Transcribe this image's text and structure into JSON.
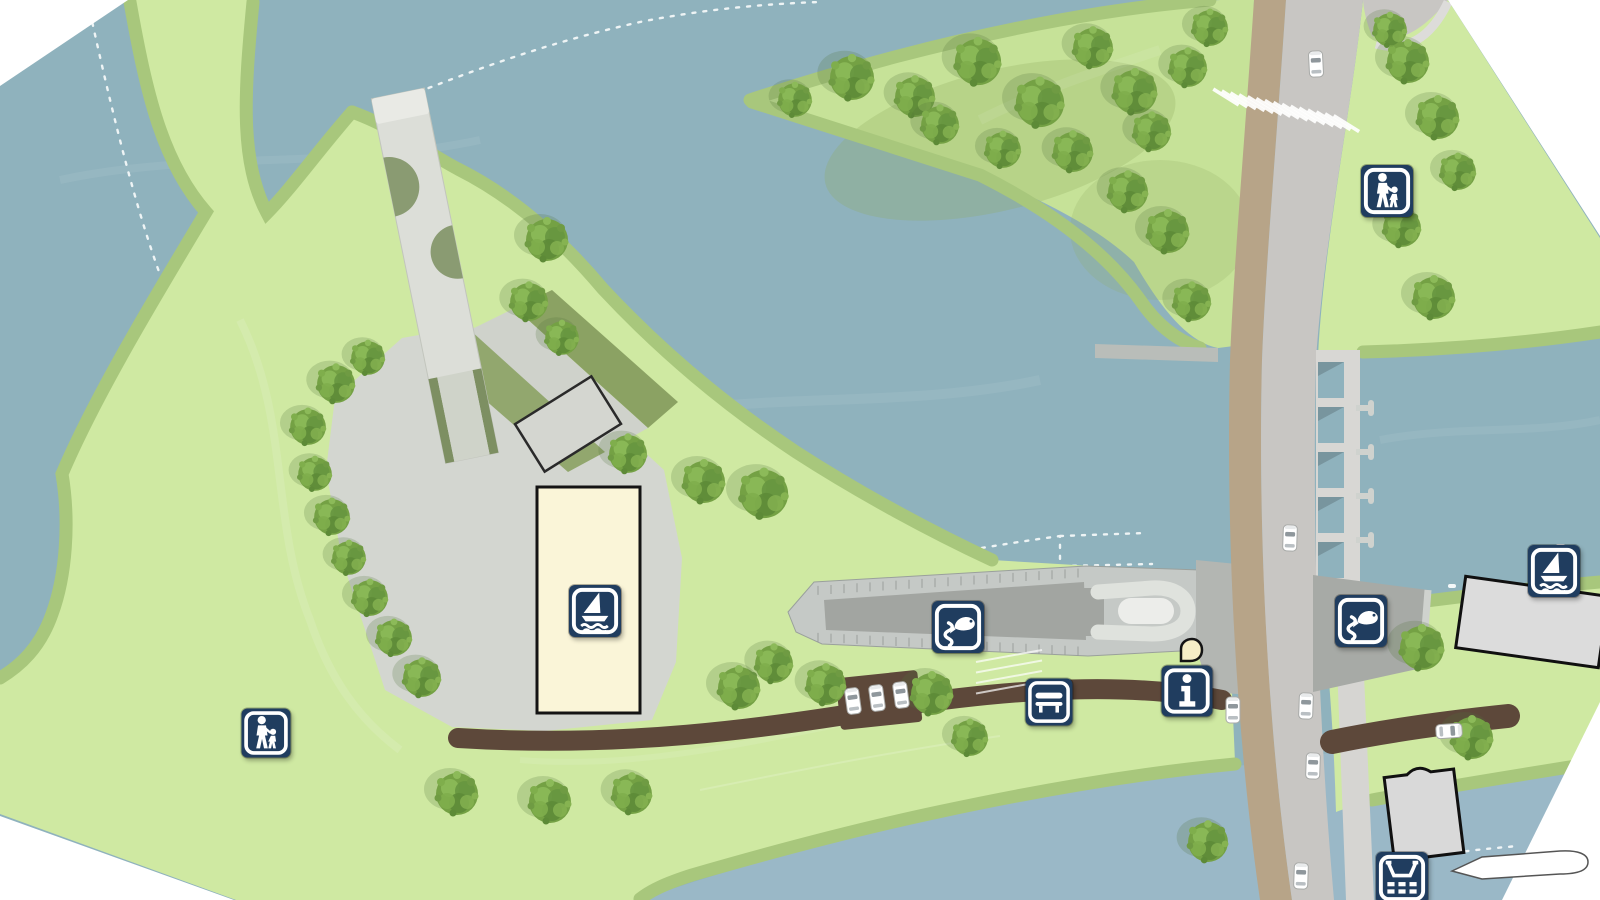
{
  "map": {
    "kind": "waterfront-park-site-plan",
    "colors": {
      "water": "#8fb2bd",
      "water_channel": "#9bb8c8",
      "land_green": "#cfe9a2",
      "bank_green": "#a8c77c",
      "hedge_green": "#8ba263",
      "plaza_gray": "#d3d6d0",
      "road_gray": "#c8c6c3",
      "bike_path_tan": "#b7a488",
      "boardwalk_brown": "#5d483a",
      "lock_gray": "#c5c9c6",
      "badge_navy": "#203d5f",
      "building_cream": "#faf5d8",
      "building_gray": "#dcdcdc",
      "marker_cream": "#f6eec6"
    },
    "badges": [
      {
        "id": "pedestrian-zone-north",
        "icon": "pedestrian",
        "x": 1387,
        "y": 191,
        "size": 52
      },
      {
        "id": "pedestrian-zone-west",
        "icon": "pedestrian",
        "x": 266,
        "y": 733,
        "size": 49
      },
      {
        "id": "boat-hall",
        "icon": "sailboat",
        "x": 595,
        "y": 611,
        "size": 52
      },
      {
        "id": "marina-east",
        "icon": "sailboat",
        "x": 1554,
        "y": 571,
        "size": 52
      },
      {
        "id": "fish-ladder-west",
        "icon": "fish-ladder",
        "x": 958,
        "y": 627,
        "size": 52
      },
      {
        "id": "fish-ladder-east",
        "icon": "fish-ladder",
        "x": 1361,
        "y": 621,
        "size": 52
      },
      {
        "id": "bench-rest-area",
        "icon": "bench",
        "x": 1049,
        "y": 702,
        "size": 47
      },
      {
        "id": "information-point",
        "icon": "info",
        "x": 1187,
        "y": 691,
        "size": 51
      },
      {
        "id": "slipway-south",
        "icon": "slipway",
        "x": 1402,
        "y": 878,
        "size": 52
      }
    ],
    "trees": [
      [
        852,
        78,
        1.05
      ],
      [
        915,
        97,
        0.95
      ],
      [
        978,
        62,
        1.1
      ],
      [
        1040,
        103,
        1.15
      ],
      [
        1093,
        48,
        0.95
      ],
      [
        1135,
        92,
        1.05
      ],
      [
        1073,
        152,
        0.95
      ],
      [
        1003,
        150,
        0.85
      ],
      [
        1152,
        132,
        0.9
      ],
      [
        1188,
        68,
        0.9
      ],
      [
        1210,
        28,
        0.85
      ],
      [
        1168,
        232,
        1.0
      ],
      [
        1192,
        302,
        0.9
      ],
      [
        1128,
        192,
        0.95
      ],
      [
        940,
        125,
        0.9
      ],
      [
        795,
        100,
        0.8
      ],
      [
        1408,
        62,
        1.0
      ],
      [
        1438,
        118,
        1.0
      ],
      [
        1402,
        228,
        0.9
      ],
      [
        1434,
        298,
        1.0
      ],
      [
        1458,
        172,
        0.85
      ],
      [
        1390,
        30,
        0.8
      ],
      [
        1422,
        648,
        1.05
      ],
      [
        1472,
        738,
        1.0
      ],
      [
        1208,
        842,
        0.95
      ],
      [
        336,
        384,
        0.9
      ],
      [
        368,
        358,
        0.8
      ],
      [
        308,
        427,
        0.85
      ],
      [
        315,
        474,
        0.8
      ],
      [
        332,
        517,
        0.85
      ],
      [
        349,
        558,
        0.8
      ],
      [
        370,
        598,
        0.85
      ],
      [
        394,
        638,
        0.85
      ],
      [
        422,
        678,
        0.9
      ],
      [
        547,
        240,
        1.0
      ],
      [
        529,
        302,
        0.9
      ],
      [
        562,
        338,
        0.8
      ],
      [
        628,
        454,
        0.9
      ],
      [
        704,
        482,
        1.0
      ],
      [
        764,
        494,
        1.15
      ],
      [
        739,
        688,
        1.0
      ],
      [
        774,
        664,
        0.9
      ],
      [
        826,
        685,
        0.95
      ],
      [
        932,
        694,
        1.0
      ],
      [
        970,
        738,
        0.85
      ],
      [
        457,
        794,
        1.0
      ],
      [
        550,
        802,
        1.0
      ],
      [
        632,
        794,
        0.95
      ]
    ],
    "cars": [
      [
        1316,
        64,
        -3
      ],
      [
        1290,
        538,
        2
      ],
      [
        1233,
        710,
        0
      ],
      [
        1306,
        706,
        2
      ],
      [
        1313,
        766,
        2
      ],
      [
        1449,
        731,
        86
      ],
      [
        853,
        701,
        -8
      ],
      [
        877,
        698,
        -8
      ],
      [
        901,
        695,
        -8
      ],
      [
        1301,
        876,
        2
      ]
    ]
  }
}
